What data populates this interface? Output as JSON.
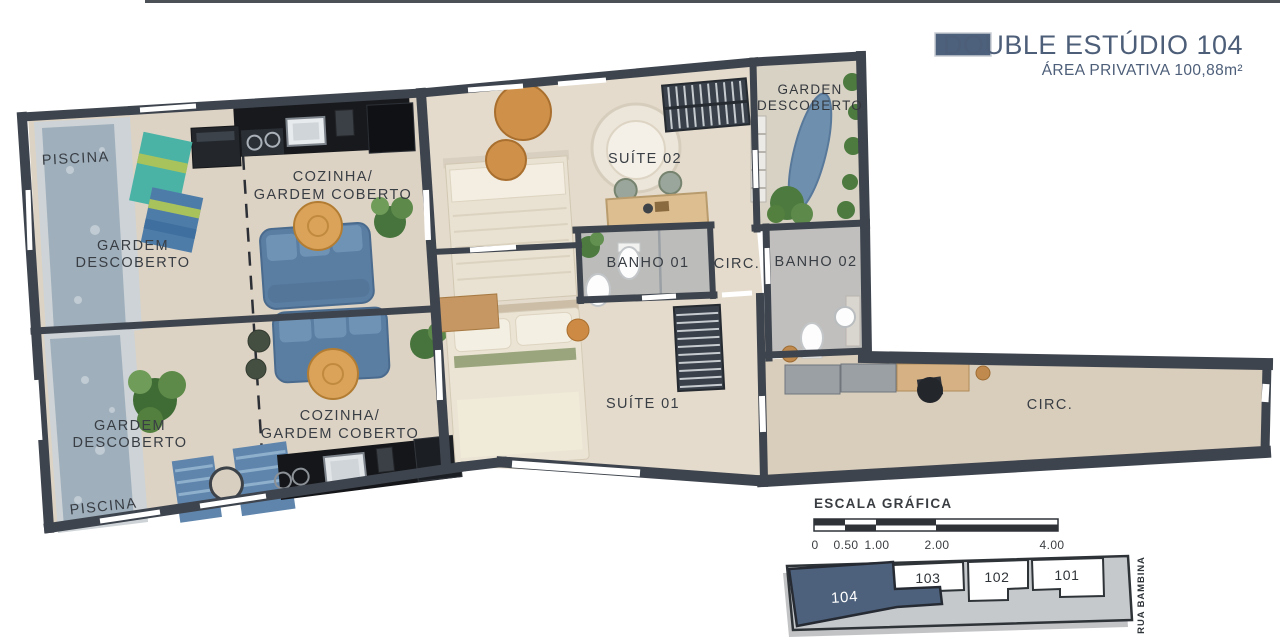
{
  "header": {
    "title": "DOUBLE ESTÚDIO 104",
    "subtitle": "ÁREA PRIVATIVA 100,88m²",
    "accent_color": "#4d5e79"
  },
  "plan": {
    "rooms": {
      "piscina_top": "PISCINA",
      "gardem_top_1": "GARDEM",
      "gardem_top_2": "DESCOBERTO",
      "cozinha_top_1": "COZINHA/",
      "cozinha_top_2": "GARDEM COBERTO",
      "suite02": "SUÍTE 02",
      "garden_right_1": "GARDEN",
      "garden_right_2": "DESCOBERTO",
      "banho01": "BANHO 01",
      "circ_center": "CIRC.",
      "banho02": "BANHO 02",
      "suite01": "SUÍTE 01",
      "circ_right": "CIRC.",
      "gardem_bottom_1": "GARDEM",
      "gardem_bottom_2": "DESCOBERTO",
      "cozinha_bottom_1": "COZINHA/",
      "cozinha_bottom_2": "GARDEM COBERTO",
      "piscina_bottom": "PISCINA"
    },
    "colors": {
      "wall": "#3e444d",
      "floor_outdoor": "#ddd3c4",
      "floor_suite": "#e4dbcc",
      "floor_bath": "#bcbcba",
      "pool": "#9fafbc",
      "sofa": "#5a7da2",
      "wood": "#dba25a"
    }
  },
  "scale": {
    "title": "ESCALA GRÁFICA",
    "ticks": [
      "0",
      "0.50",
      "1.00",
      "2.00",
      "4.00"
    ]
  },
  "keyplan": {
    "units": [
      {
        "id": "104",
        "highlighted": true
      },
      {
        "id": "103",
        "highlighted": false
      },
      {
        "id": "102",
        "highlighted": false
      },
      {
        "id": "101",
        "highlighted": false
      }
    ],
    "street": "RUA BAMBINA",
    "highlight_color": "#4d617c"
  }
}
